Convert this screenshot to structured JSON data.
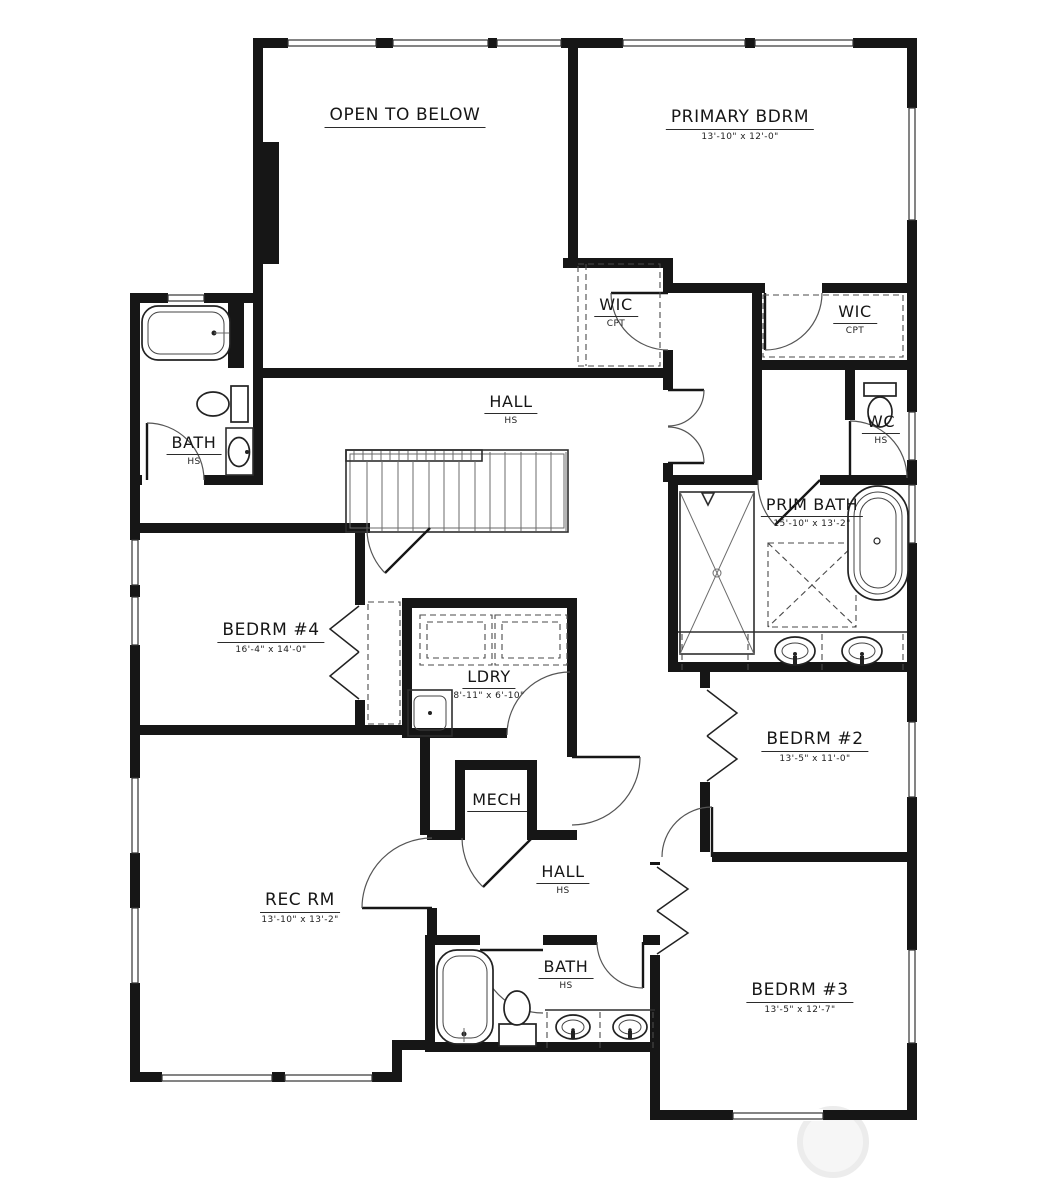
{
  "plan_type": "second-floor-plan",
  "rooms": {
    "open_below": {
      "name": "OPEN TO BELOW",
      "sub": ""
    },
    "primary": {
      "name": "PRIMARY BDRM",
      "sub": "13'-10\" x 12'-0\""
    },
    "wic_left": {
      "name": "WIC",
      "sub": "CPT"
    },
    "wic_right": {
      "name": "WIC",
      "sub": "CPT"
    },
    "hall_upper": {
      "name": "HALL",
      "sub": "HS"
    },
    "bath_upper": {
      "name": "BATH",
      "sub": "HS"
    },
    "wc": {
      "name": "WC",
      "sub": "HS"
    },
    "prim_bath": {
      "name": "PRIM BATH",
      "sub": "15'-10\" x 13'-2\""
    },
    "bedrm4": {
      "name": "BEDRM #4",
      "sub": "16'-4\" x 14'-0\""
    },
    "ldry": {
      "name": "LDRY",
      "sub": "8'-11\" x 6'-10\""
    },
    "mech": {
      "name": "MECH",
      "sub": ""
    },
    "hall_lower": {
      "name": "HALL",
      "sub": "HS"
    },
    "rec_rm": {
      "name": "REC RM",
      "sub": "13'-10\" x 13'-2\""
    },
    "bedrm2": {
      "name": "BEDRM #2",
      "sub": "13'-5\" x 11'-0\""
    },
    "bath_lower": {
      "name": "BATH",
      "sub": "HS"
    },
    "bedrm3": {
      "name": "BEDRM #3",
      "sub": "13'-5\" x 12'-7\""
    }
  },
  "colors": {
    "wall": "#161616",
    "line": "#2e2e2e",
    "background": "#ffffff",
    "watermark": "#f0f0f0"
  }
}
